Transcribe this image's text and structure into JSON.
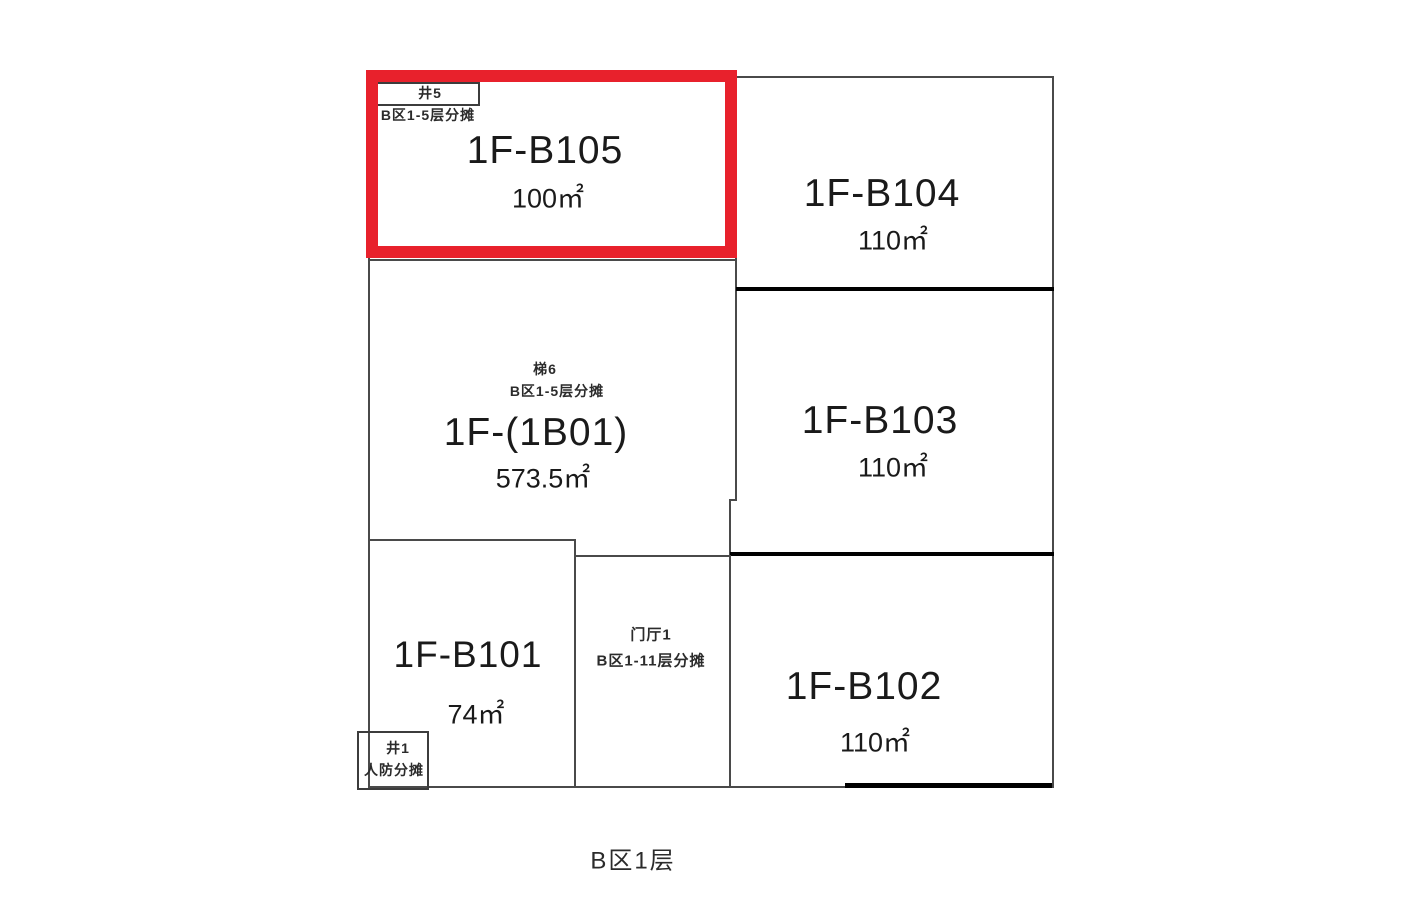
{
  "caption": "B区1层",
  "colors": {
    "highlight": "#e8212c",
    "wall": "#4a4a4a",
    "wall_thick": "#000000",
    "text": "#1a1a1a"
  },
  "rooms": {
    "b105": {
      "name": "1F-B105",
      "area": "100㎡",
      "highlighted": true
    },
    "b104": {
      "name": "1F-B104",
      "area": "110㎡"
    },
    "unit_1b01": {
      "name": "1F-(1B01)",
      "area": "573.5㎡"
    },
    "b103": {
      "name": "1F-B103",
      "area": "110㎡"
    },
    "b101": {
      "name": "1F-B101",
      "area": "74㎡"
    },
    "b102": {
      "name": "1F-B102",
      "area": "110㎡"
    }
  },
  "shared_areas": {
    "shaft5": {
      "name": "井5",
      "note": "B区1-5层分摊"
    },
    "stair6": {
      "name": "梯6",
      "note": "B区1-5层分摊"
    },
    "lobby1": {
      "name": "门厅1",
      "note": "B区1-11层分摊"
    },
    "shaft1": {
      "name": "井1",
      "note": "人防分摊"
    }
  }
}
